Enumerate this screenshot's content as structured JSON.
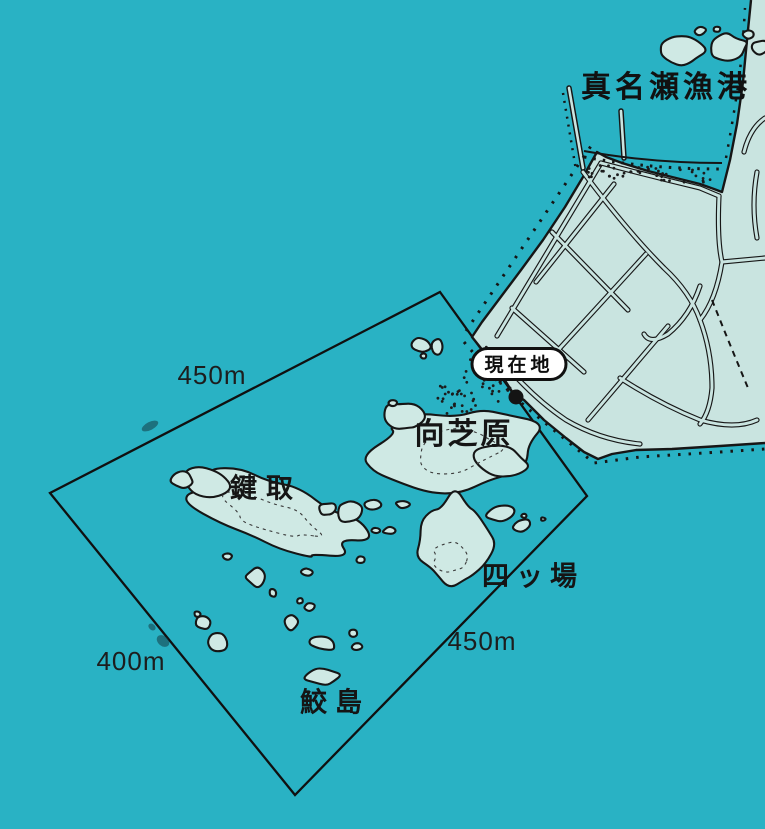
{
  "map": {
    "title": "真名瀬漁港",
    "current_location_label": "現在地",
    "places": {
      "mukaishibahara": "向芝原",
      "kagitori": "鍵取",
      "yotsuba": "四ッ場",
      "samejima": "鮫島"
    },
    "distances": {
      "top_left": "450m",
      "bottom_left": "400m",
      "bottom_right": "450m"
    },
    "colors": {
      "sea": "#29b2c4",
      "land": "#c9e4e0",
      "rock": "#cfe9e4",
      "ink": "#161616",
      "marker_bg": "#ffffff"
    }
  }
}
